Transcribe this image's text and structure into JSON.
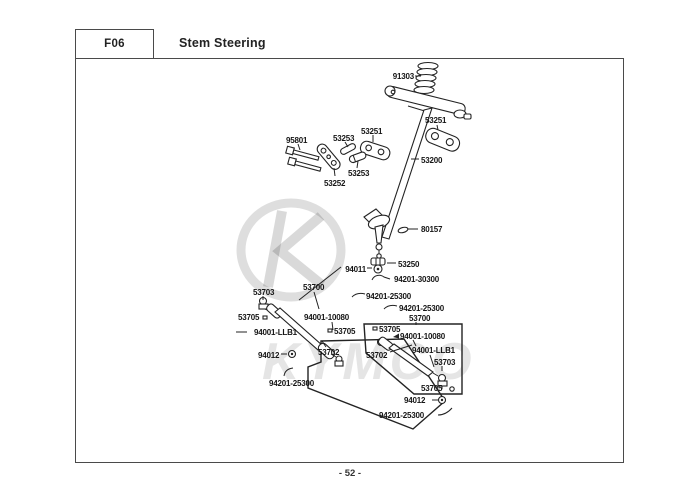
{
  "header": {
    "code": "F06",
    "title": "Stem Steering"
  },
  "footer": {
    "page_number": "- 52 -"
  },
  "watermark": {
    "text": "KYMCO"
  },
  "parts": {
    "p91303": "91303",
    "p53251": "53251",
    "p95801": "95801",
    "p53253": "53253",
    "p53252": "53252",
    "p53200": "53200",
    "p80157": "80157",
    "p53250": "53250",
    "p94011": "94011",
    "p94201_30300": "94201-30300",
    "p94201_25300": "94201-25300",
    "p53700": "53700",
    "p53703": "53703",
    "p53705": "53705",
    "p94001_10080": "94001-10080",
    "p94001_llb1": "94001-LLB1",
    "p94012": "94012",
    "p53702": "53702"
  },
  "colors": {
    "line": "#232323",
    "border": "#4a4a4a",
    "watermark_gray": "#d9d9d9"
  }
}
